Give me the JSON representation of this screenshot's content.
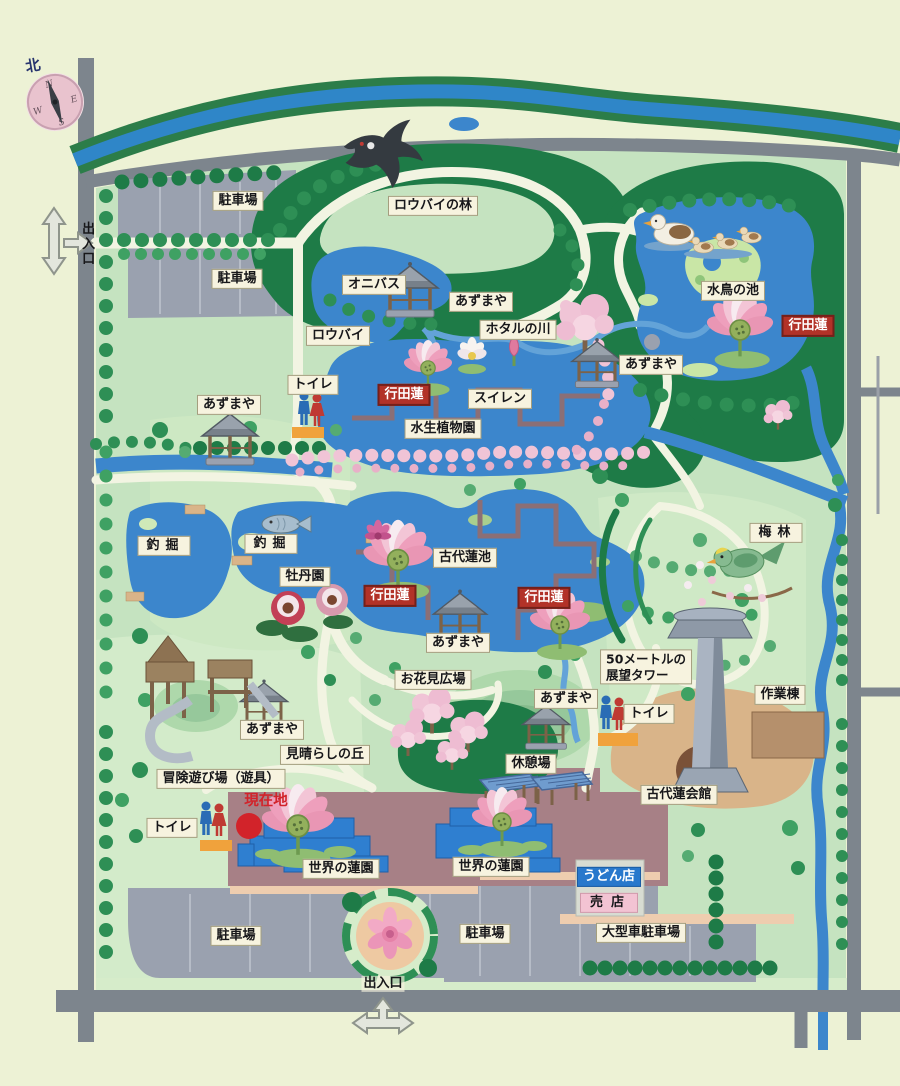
{
  "map": {
    "compass": {
      "mark": "北",
      "n": "N",
      "e": "E",
      "s": "S",
      "w": "W"
    },
    "labels": [
      {
        "text": "駐車場"
      },
      {
        "text": "駐車場"
      },
      {
        "text": "ロウバイの林"
      },
      {
        "text": "オニバス"
      },
      {
        "text": "あずまや"
      },
      {
        "text": "ホタルの川"
      },
      {
        "text": "ロウバイ"
      },
      {
        "text": "水鳥の池"
      },
      {
        "text": "行田蓮"
      },
      {
        "text": "あずまや"
      },
      {
        "text": "トイレ"
      },
      {
        "text": "行田蓮"
      },
      {
        "text": "スイレン"
      },
      {
        "text": "水生植物園"
      },
      {
        "text": "あずまや"
      },
      {
        "text": "釣掘"
      },
      {
        "text": "釣掘"
      },
      {
        "text": "牡丹園"
      },
      {
        "text": "古代蓮池"
      },
      {
        "text": "行田蓮"
      },
      {
        "text": "行田蓮"
      },
      {
        "text": "あずまや"
      },
      {
        "text": "お花見広場"
      },
      {
        "text": "梅林"
      },
      {
        "line1": "50メートルの",
        "line2": "展望タワー"
      },
      {
        "text": "作業棟"
      },
      {
        "text": "トイレ"
      },
      {
        "text": "あずまや"
      },
      {
        "text": "休憩場"
      },
      {
        "text": "古代蓮会館"
      },
      {
        "text": "あずまや"
      },
      {
        "text": "見晴らしの丘"
      },
      {
        "text": "冒険遊び場（遊具）"
      },
      {
        "text": "現在地"
      },
      {
        "text": "トイレ"
      },
      {
        "text": "世界の蓮園"
      },
      {
        "text": "世界の蓮園"
      },
      {
        "text": "うどん店"
      },
      {
        "text": "売店"
      },
      {
        "text": "駐車場"
      },
      {
        "text": "駐車場"
      },
      {
        "text": "大型車駐車場"
      },
      {
        "text": "出入口"
      },
      {
        "text": "出入口"
      }
    ],
    "colors": {
      "label_bg": "#f7f3df",
      "lotus_label_red": "#b23228",
      "shop_label_blue": "#2878cc",
      "shop_label_pink": "#f3c3d3",
      "current_location_red": "#d2232a",
      "pond_blue": "#3c86cc",
      "road_gray": "#7d858d",
      "park_green": "#c5e3c0",
      "forest_green": "#1e7b47",
      "plaza_mauve": "#a78086"
    }
  }
}
